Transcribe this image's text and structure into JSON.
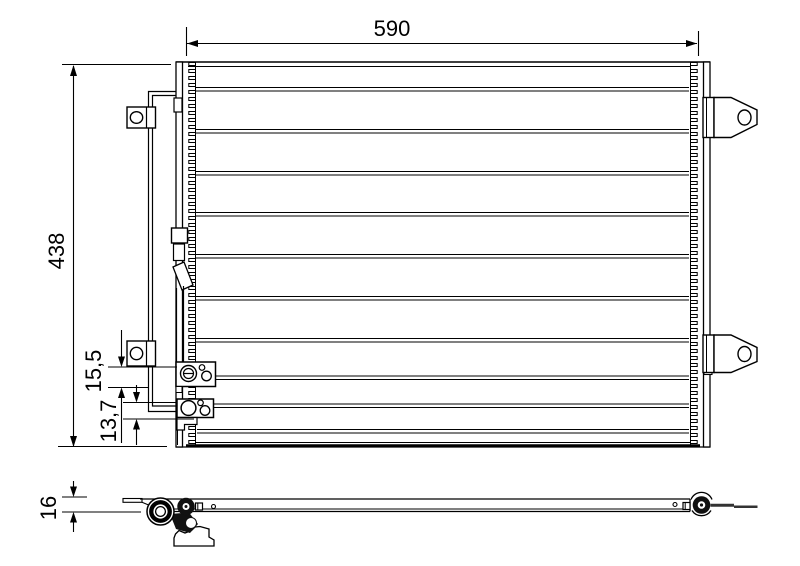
{
  "drawing": {
    "subject": "condenser-technical-drawing",
    "background_color": "#ffffff",
    "line_color": "#000000"
  },
  "dimensions": {
    "width_label": "590",
    "height_label": "438",
    "upper_offset_label": "15,5",
    "lower_offset_label": "13,7",
    "depth_label": "16"
  }
}
